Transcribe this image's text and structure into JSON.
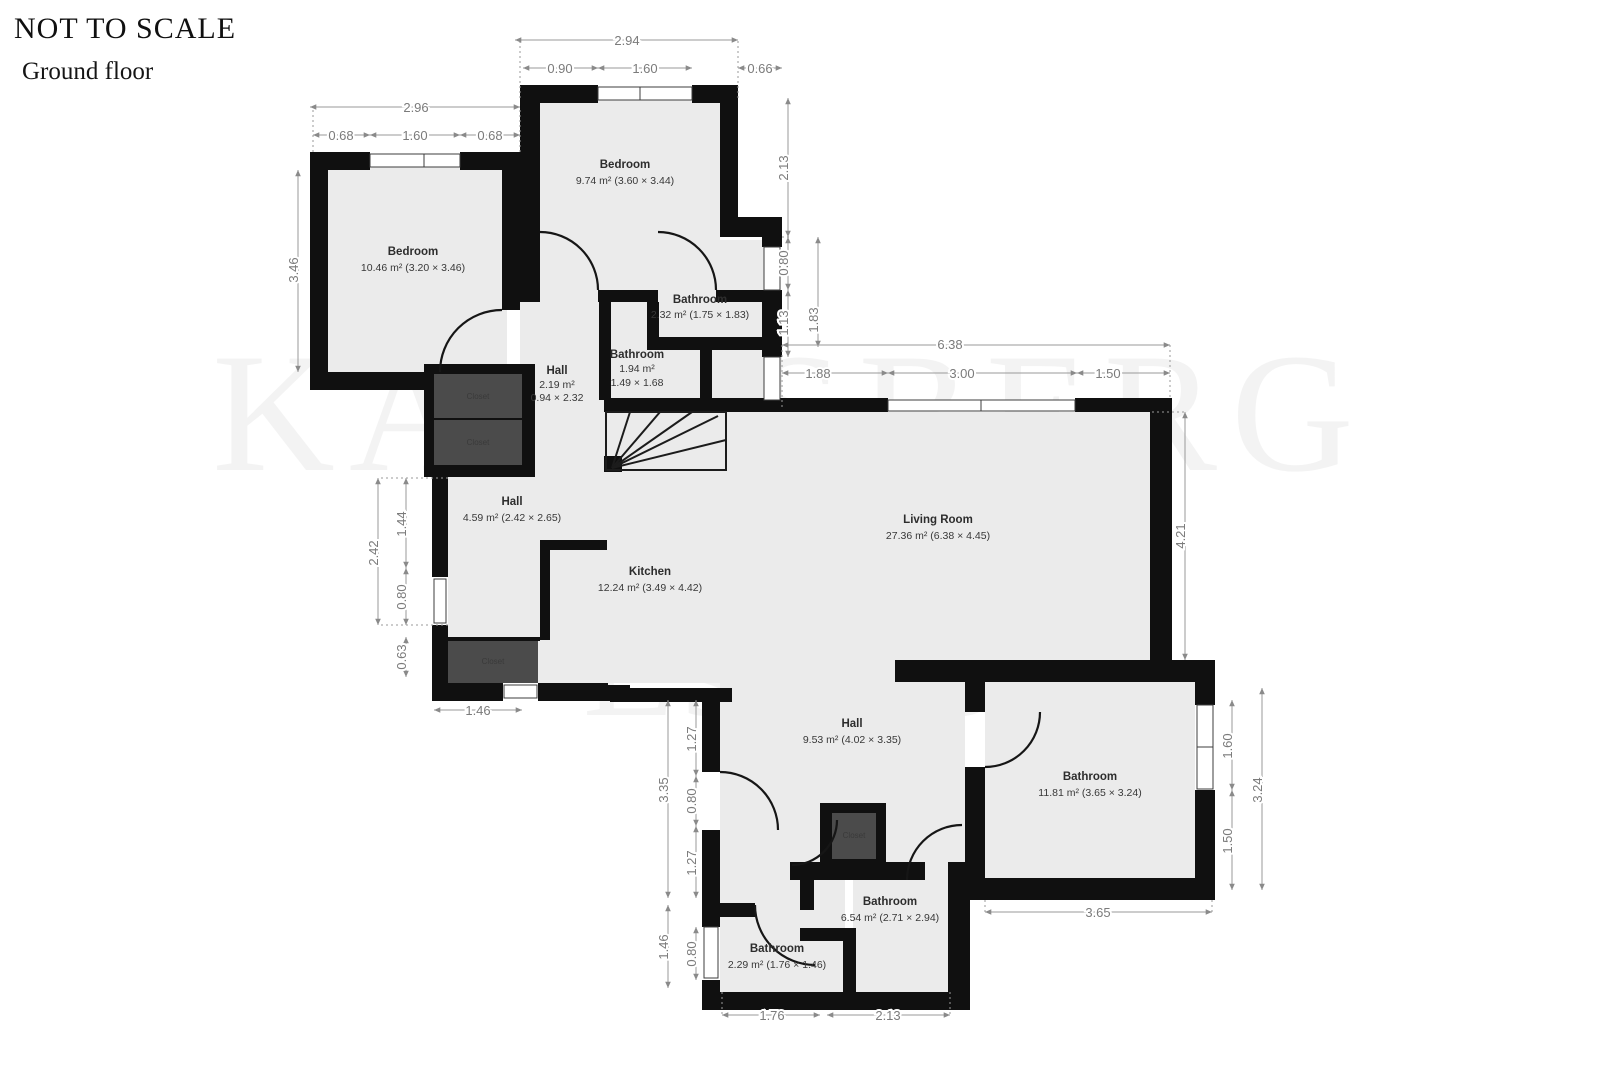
{
  "header": {
    "not_to_scale": "NOT TO SCALE",
    "floor_label": "Ground floor"
  },
  "watermark": {
    "line1": "KAARSBERG",
    "line2": "Estate"
  },
  "colors": {
    "wall": "#101010",
    "room_fill": "#ebebeb",
    "dim_text": "#7b7b7b",
    "closet_fill": "#4b4b4b",
    "background": "#ffffff"
  },
  "rooms": [
    {
      "name": "Bedroom",
      "area": "9.74 m² (3.60 × 3.44)"
    },
    {
      "name": "Bedroom",
      "area": "10.46 m² (3.20 × 3.46)"
    },
    {
      "name": "Bathroom",
      "area": "2.32 m² (1.75 × 1.83)"
    },
    {
      "name": "Bathroom",
      "area": "1.94 m²",
      "area2": "1.49 × 1.68"
    },
    {
      "name": "Hall",
      "area": "2.19 m²",
      "area2": "0.94 × 2.32"
    },
    {
      "name": "Hall",
      "area": "4.59 m² (2.42 × 2.65)"
    },
    {
      "name": "Living Room",
      "area": "27.36 m² (6.38 × 4.45)"
    },
    {
      "name": "Kitchen",
      "area": "12.24 m² (3.49 × 4.42)"
    },
    {
      "name": "Hall",
      "area": "9.53 m² (4.02 × 3.35)"
    },
    {
      "name": "Bathroom",
      "area": "11.81 m² (3.65 × 3.24)"
    },
    {
      "name": "Bathroom",
      "area": "6.54 m² (2.71 × 2.94)"
    },
    {
      "name": "Bathroom",
      "area": "2.29 m² (1.76 × 1.46)"
    }
  ],
  "closets": [
    {
      "name": "Closet"
    },
    {
      "name": "Closet"
    },
    {
      "name": "Closet"
    },
    {
      "name": "Closet"
    }
  ],
  "dims": {
    "top_bed": {
      "overall": "2.94",
      "left": "0.90",
      "window": "1.60",
      "right": "0.66"
    },
    "top_bed_side": {
      "a": "2.13",
      "b": "0.80",
      "c": "1.13",
      "d": "1.83"
    },
    "left_bed": {
      "overall": "2.96",
      "left": "0.68",
      "window": "1.60",
      "right": "0.68",
      "height": "3.46"
    },
    "living": {
      "overall": "6.38",
      "a": "1.88",
      "b": "3.00",
      "c": "1.50",
      "height": "4.21"
    },
    "left_hall": {
      "overall": "2.42",
      "a": "1.44",
      "b": "0.80",
      "c": "0.63",
      "bottom": "1.46"
    },
    "bottom_hall": {
      "overall": "3.35",
      "a": "1.27",
      "b": "0.80",
      "c": "1.27",
      "d": "1.46",
      "e": "0.80"
    },
    "bottom": {
      "a": "1.76",
      "b": "2.13",
      "c": "3.65"
    },
    "right_bath": {
      "a": "1.60",
      "b": "1.50",
      "overall": "3.24"
    }
  }
}
